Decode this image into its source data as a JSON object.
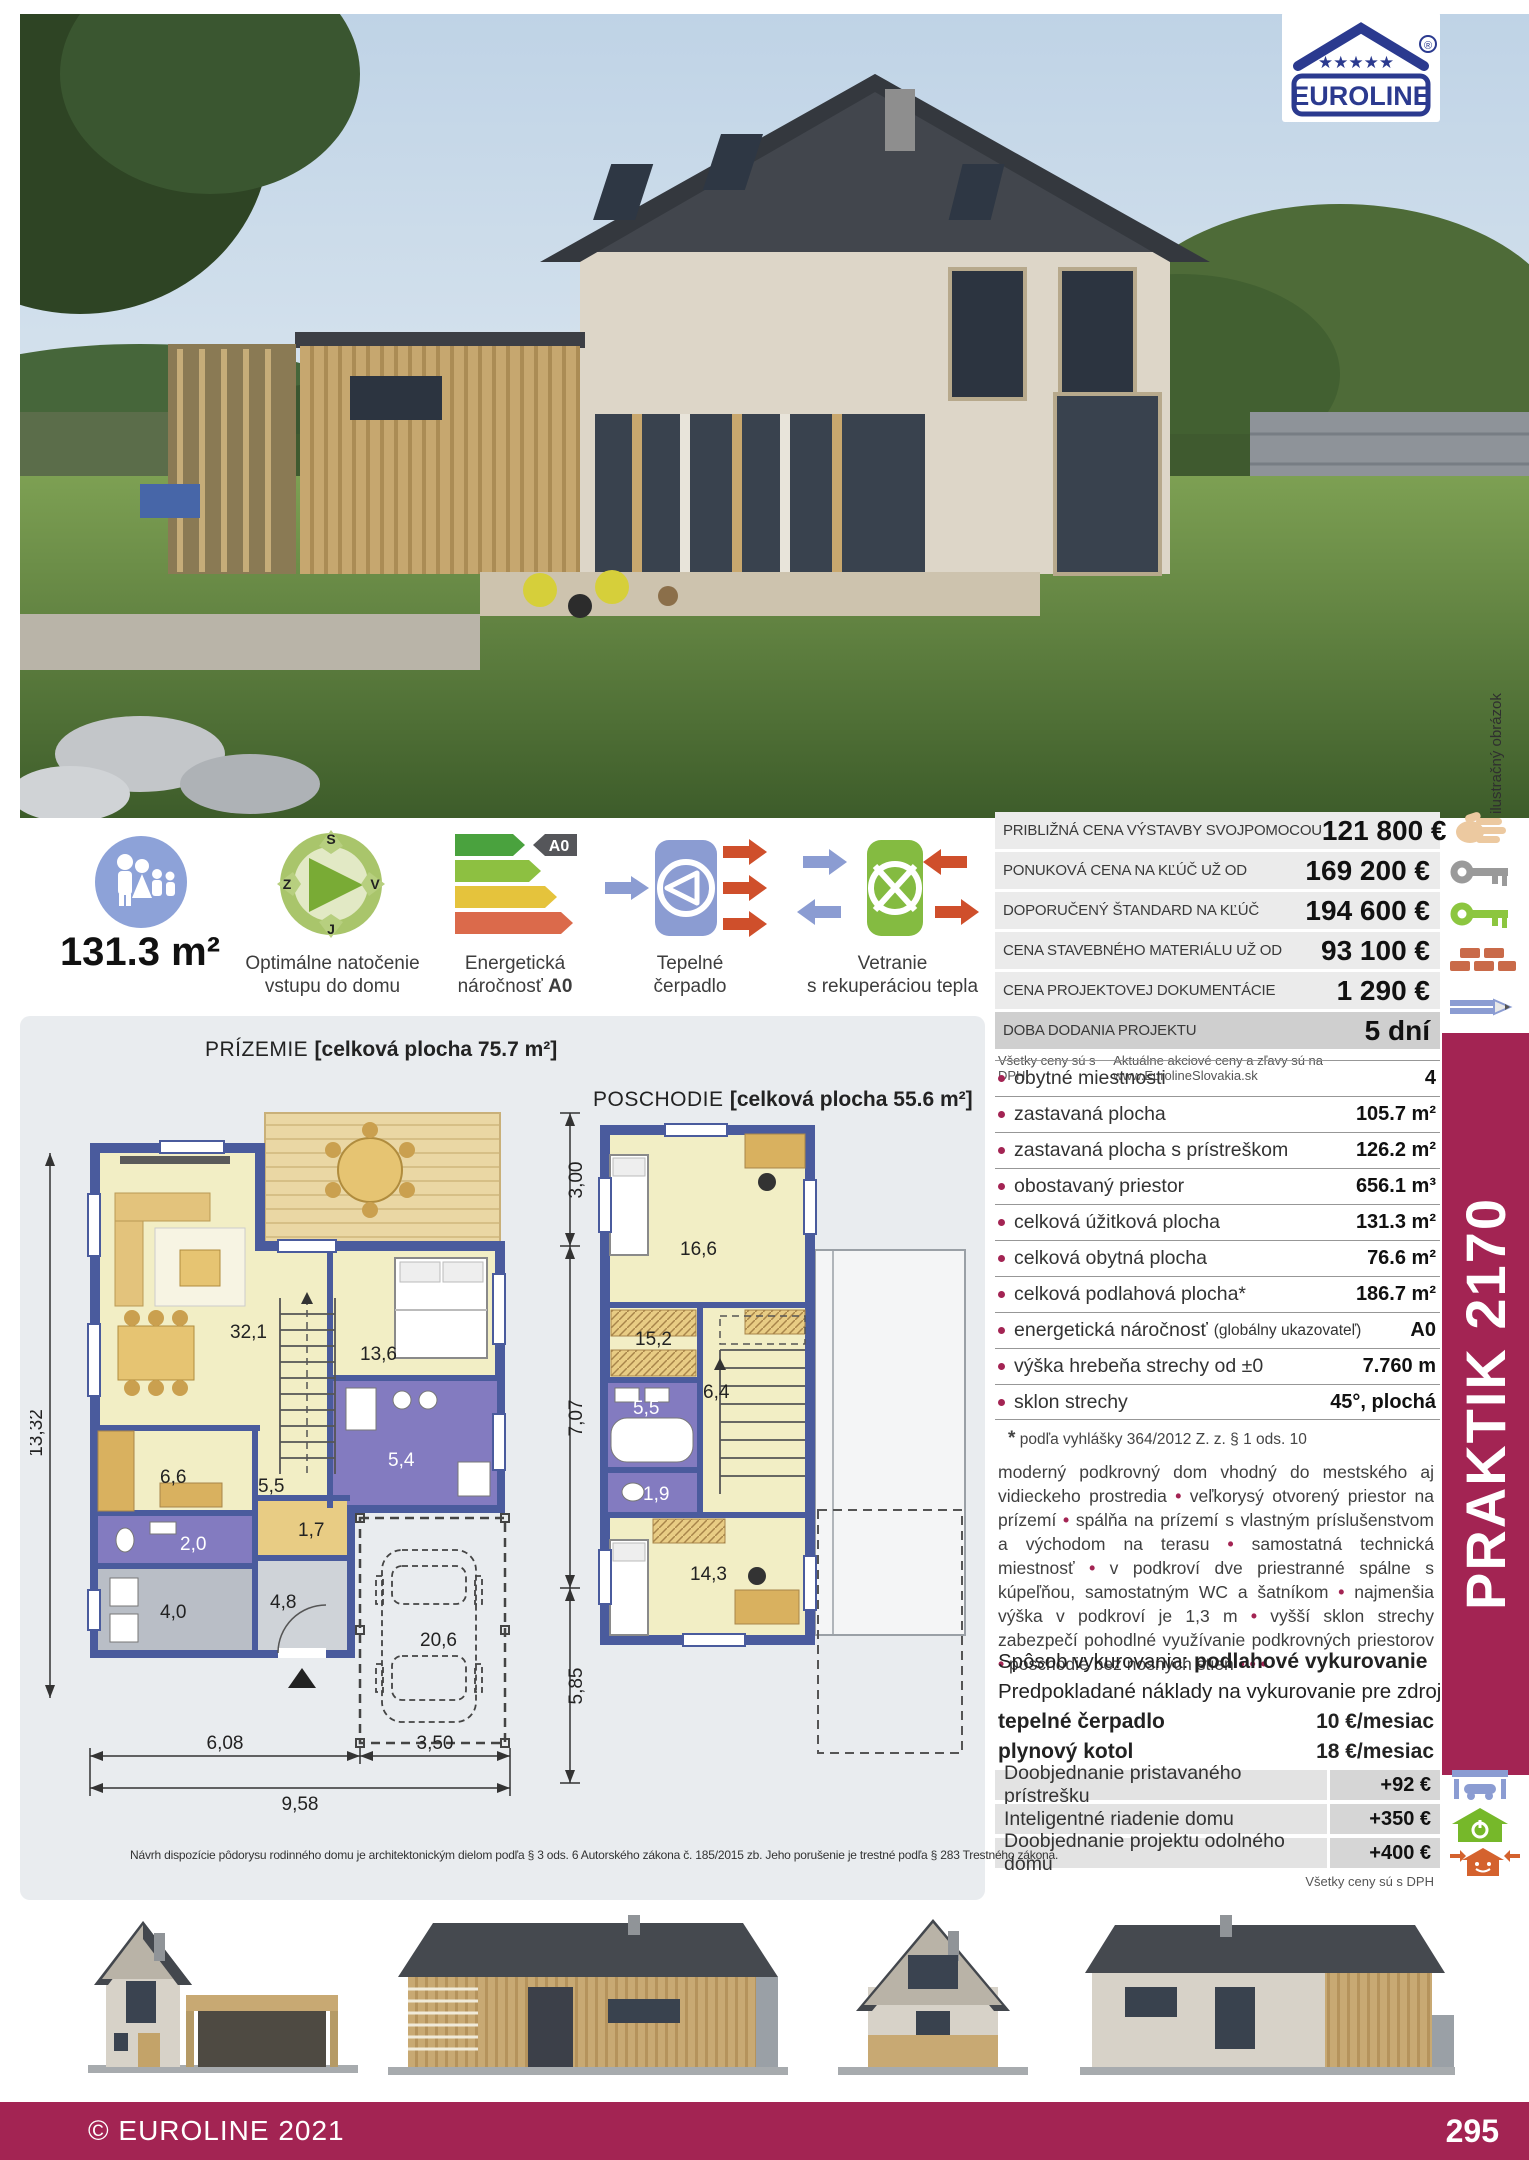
{
  "page": {
    "photo_note": "ilustračný obrázok",
    "disclaimer": "Návrh dispozície pôdorysu rodinného domu je architektonickým dielom podľa § 3 ods. 6 Autorského zákona č. 185/2015 zb. Jeho porušenie je trestné podľa § 283 Trestného zákona.",
    "footer_copyright": "© EUROLINE 2021",
    "page_number": "295",
    "model_name": "PRAKTIK 2170"
  },
  "logo": {
    "name": "EUROLINE",
    "registered": "®",
    "brand_color": "#2b3a8f"
  },
  "features": {
    "area": "131.3 m²",
    "compass": {
      "line1": "Optimálne natočenie",
      "line2": "vstupu do domu",
      "n": "S",
      "e": "V",
      "s": "J",
      "w": "Z"
    },
    "energy": {
      "line1": "Energetická",
      "line2": "náročnosť",
      "badge": "A0"
    },
    "pump": {
      "line1": "Tepelné",
      "line2": "čerpadlo"
    },
    "vent": {
      "line1": "Vetranie",
      "line2": "s rekuperáciou tepla"
    }
  },
  "price_table": {
    "rows": [
      {
        "label": "PRIBLIŽNÁ CENA VÝSTAVBY SVOJPOMOCOU",
        "value": "121 800 €"
      },
      {
        "label": "PONUKOVÁ CENA NA KĽÚČ UŽ OD",
        "value": "169 200 €"
      },
      {
        "label": "DOPORUČENÝ ŠTANDARD NA KĽÚČ",
        "value": "194 600 €"
      },
      {
        "label": "CENA STAVEBNÉHO MATERIÁLU UŽ OD",
        "value": "93 100 €"
      },
      {
        "label": "CENA PROJEKTOVEJ DOKUMENTÁCIE",
        "value": "1 290 €"
      },
      {
        "label": "DOBA DODANIA PROJEKTU",
        "value": "5 dní"
      }
    ],
    "note_left": "Všetky ceny sú s DPH",
    "note_right": "Aktuálne akciové ceny a zľavy sú na www.EurolineSlovakia.sk"
  },
  "specs": {
    "rows": [
      {
        "label": "obytné miestnosti",
        "value": "4"
      },
      {
        "label": "zastavaná plocha",
        "value": "105.7 m²"
      },
      {
        "label": "zastavaná plocha s prístreškom",
        "value": "126.2 m²"
      },
      {
        "label": "obostavaný priestor",
        "value": "656.1 m³"
      },
      {
        "label": "celková úžitková plocha",
        "value": "131.3 m²"
      },
      {
        "label": "celková obytná plocha",
        "value": "76.6 m²"
      },
      {
        "label": "celková podlahová plocha*",
        "value": "186.7 m²"
      },
      {
        "label": "energetická náročnosť",
        "note": "(globálny ukazovateľ)",
        "value": "A0"
      },
      {
        "label": "výška hrebeňa strechy od ±0",
        "value": "7.760 m"
      },
      {
        "label": "sklon strechy",
        "value": "45°, plochá"
      }
    ],
    "footnote_star": "*",
    "footnote": "podľa vyhlášky 364/2012 Z. z. § 1 ods. 10"
  },
  "description": {
    "segments": [
      "moderný podkrovný dom vhodný do mestského aj vidieckeho prostredia",
      "veľkorysý otvorený priestor na prízemí",
      "spálňa na prízemí s vlastným príslušenstvom a východom na terasu",
      "samostatná technická miestnosť",
      "v podkroví dve priestranné spálne s kúpeľňou, samostatným WC a šatníkom",
      "najmenšia výška v podkroví je 1,3 m",
      "vyšší sklon strechy zabezpečí pohodlné využívanie podkrovných priestorov",
      "poschodie bez nosných stien"
    ],
    "trailing": "• • •"
  },
  "heating": {
    "prefix": "Spôsob vykurovania:",
    "method": "podlahové vykurovanie",
    "costs_intro": "Predpokladané náklady na vykurovanie pre zdroj:",
    "rows": [
      {
        "label": "tepelné čerpadlo",
        "value": "10 €/mesiac"
      },
      {
        "label": "plynový kotol",
        "value": "18 €/mesiac"
      }
    ]
  },
  "options": {
    "rows": [
      {
        "label": "Doobjednanie pristavaného prístrešku",
        "value": "+92 €"
      },
      {
        "label": "Inteligentné riadenie domu",
        "value": "+350 €"
      },
      {
        "label": "Doobjednanie projektu odolného domu",
        "value": "+400 €"
      }
    ],
    "note": "Všetky ceny sú s DPH"
  },
  "plans": {
    "ground": {
      "title": "PRÍZEMIE",
      "area_label": "[celková plocha 75.7 m²]",
      "rooms": {
        "living": "32,1",
        "bedroom": "13,6",
        "kitchen": "6,6",
        "hall": "5,5",
        "wc": "2,0",
        "tech": "4,0",
        "entry": "4,8",
        "closet": "1,7",
        "bath": "5,4",
        "carport": "20,6"
      },
      "dims": {
        "left": "13,32",
        "right_top": "3,00",
        "right_mid": "7,07",
        "right_bottom": "5,85",
        "bottom_left": "6,08",
        "bottom_right": "3,50",
        "bottom_total": "9,58"
      }
    },
    "upper": {
      "title": "POSCHODIE",
      "area_label": "[celková plocha 55.6 m²]",
      "rooms": {
        "bedroom1": "16,6",
        "wardrobe": "15,2",
        "bath": "5,5",
        "hall": "6,4",
        "wc": "1,9",
        "bedroom2": "14,3"
      }
    }
  }
}
